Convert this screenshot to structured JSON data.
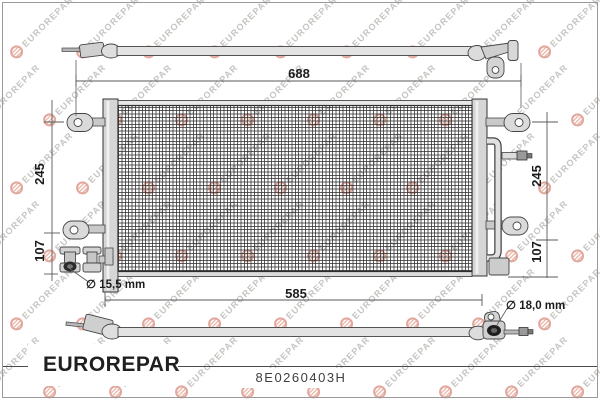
{
  "watermark": {
    "text": "EUROREPAR"
  },
  "footer": {
    "brand": "EUROREPAR",
    "part_number": "8E0260403H"
  },
  "diagram": {
    "dimensions": {
      "overall_width": "688",
      "core_width": "585",
      "left_height": "245",
      "left_lower_height": "107",
      "right_height": "245",
      "right_lower_height": "107",
      "inlet_diameter": "∅ 15,5 mm",
      "outlet_diameter": "∅ 18,0 mm"
    }
  },
  "colors": {
    "brand_red": "#e1251c",
    "line_dark": "#333333",
    "watermark_pink": "#e2a89d",
    "watermark_gray": "#c7c4c1"
  }
}
